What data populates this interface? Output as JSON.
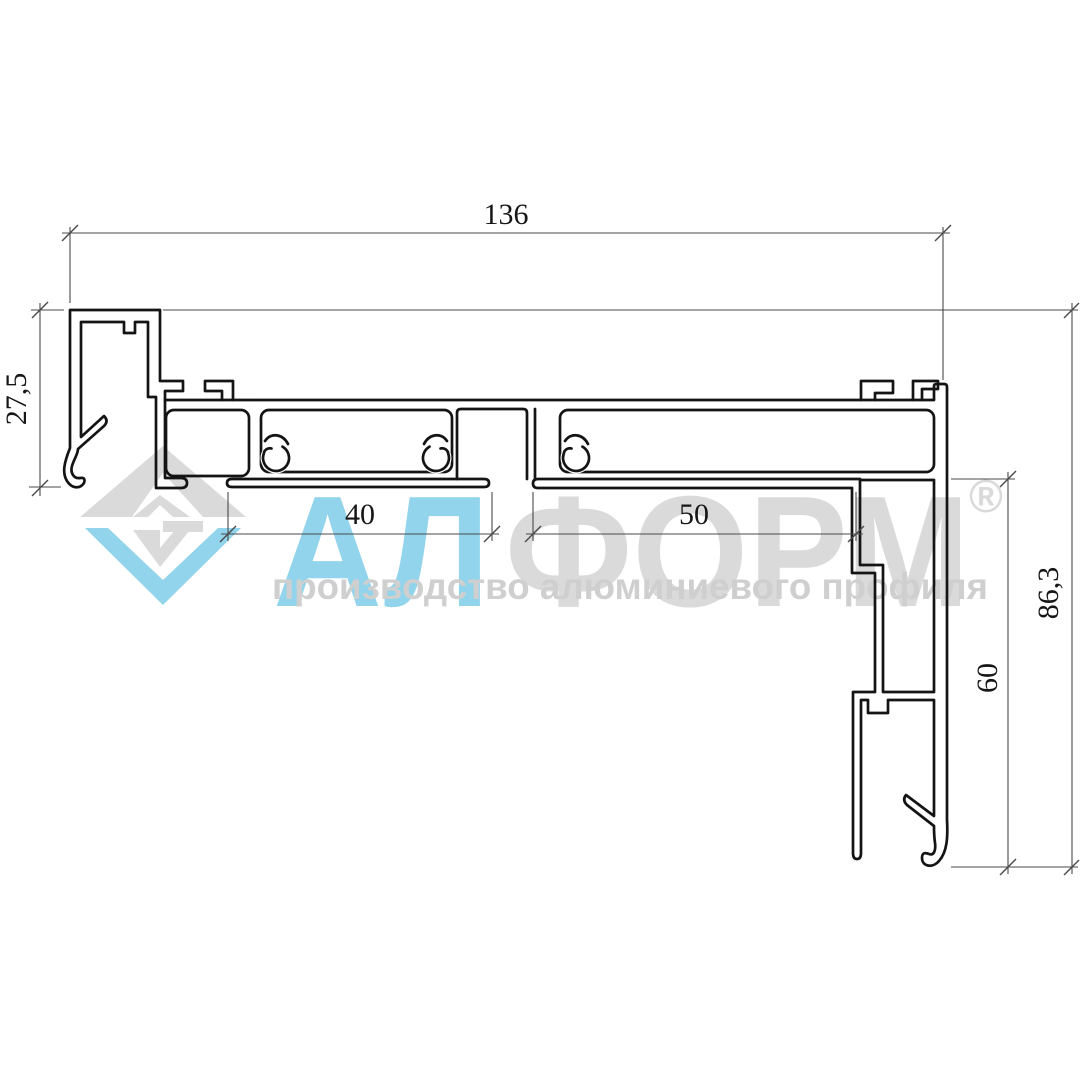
{
  "drawing": {
    "line_color": "#141414",
    "dim_color": "#4a4a4a",
    "text_color": "#161616",
    "dimensions": {
      "total_width": "136",
      "cap_height": "27,5",
      "chamber_40": "40",
      "chamber_50": "50",
      "inner_height": "60",
      "total_height": "86,3"
    }
  },
  "watermark": {
    "brand_prefix": "АЛ",
    "brand_suffix": "ФОРМ",
    "registered_mark": "®",
    "tagline": "производство алюминиевого профиля",
    "blue": "#92d4ec",
    "gray": "#dadada",
    "tagline_color": "#cfcfcf"
  }
}
